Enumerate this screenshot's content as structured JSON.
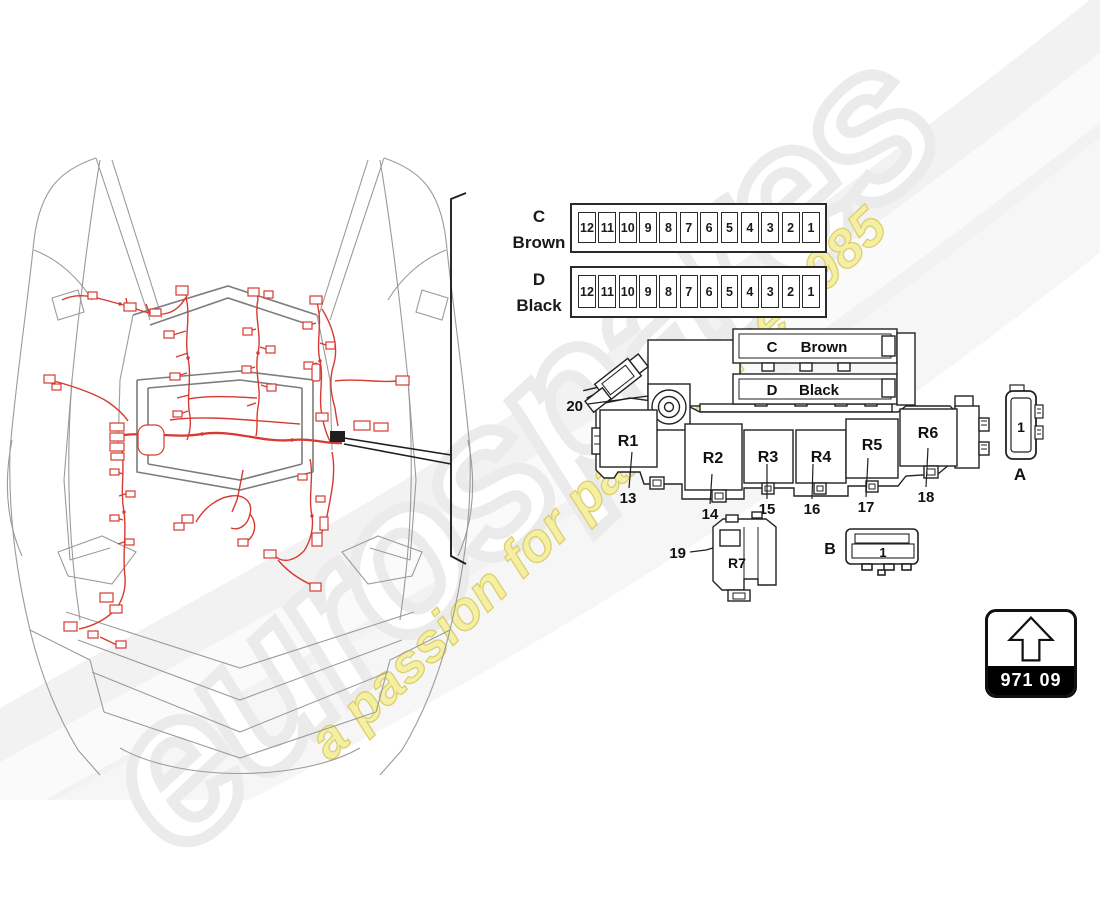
{
  "watermark": {
    "brand": "eurospares",
    "tagline": "a passion for parts since 1985"
  },
  "fuse_rows": [
    {
      "letter": "C",
      "name": "Brown",
      "fuses": [
        "12",
        "11",
        "10",
        "9",
        "8",
        "7",
        "6",
        "5",
        "4",
        "3",
        "2",
        "1"
      ]
    },
    {
      "letter": "D",
      "name": "Black",
      "fuses": [
        "12",
        "11",
        "10",
        "9",
        "8",
        "7",
        "6",
        "5",
        "4",
        "3",
        "2",
        "1"
      ]
    }
  ],
  "relay_panel": {
    "sections": [
      {
        "letter": "C",
        "name": "Brown"
      },
      {
        "letter": "D",
        "name": "Black"
      }
    ],
    "relays": [
      {
        "label": "R1",
        "callout": "13"
      },
      {
        "label": "R2",
        "callout": "14"
      },
      {
        "label": "R3",
        "callout": "15"
      },
      {
        "label": "R4",
        "callout": "16"
      },
      {
        "label": "R5",
        "callout": "17"
      },
      {
        "label": "R6",
        "callout": "18"
      }
    ],
    "connector_callout": "20"
  },
  "aux_relay": {
    "label": "R7",
    "callout": "19"
  },
  "connectors": [
    {
      "id": "A",
      "pin": "1"
    },
    {
      "id": "B",
      "pin": "1"
    }
  ],
  "part_box": {
    "code": "971 09",
    "icon": "up-arrow-icon"
  },
  "colors": {
    "harness_red": "#d63a31",
    "car_line_gray": "#9b9b9b",
    "callout_black": "#1f1f1f",
    "tagline_yellow": "#f4efa3",
    "brand_gray": "#ebebeb"
  }
}
